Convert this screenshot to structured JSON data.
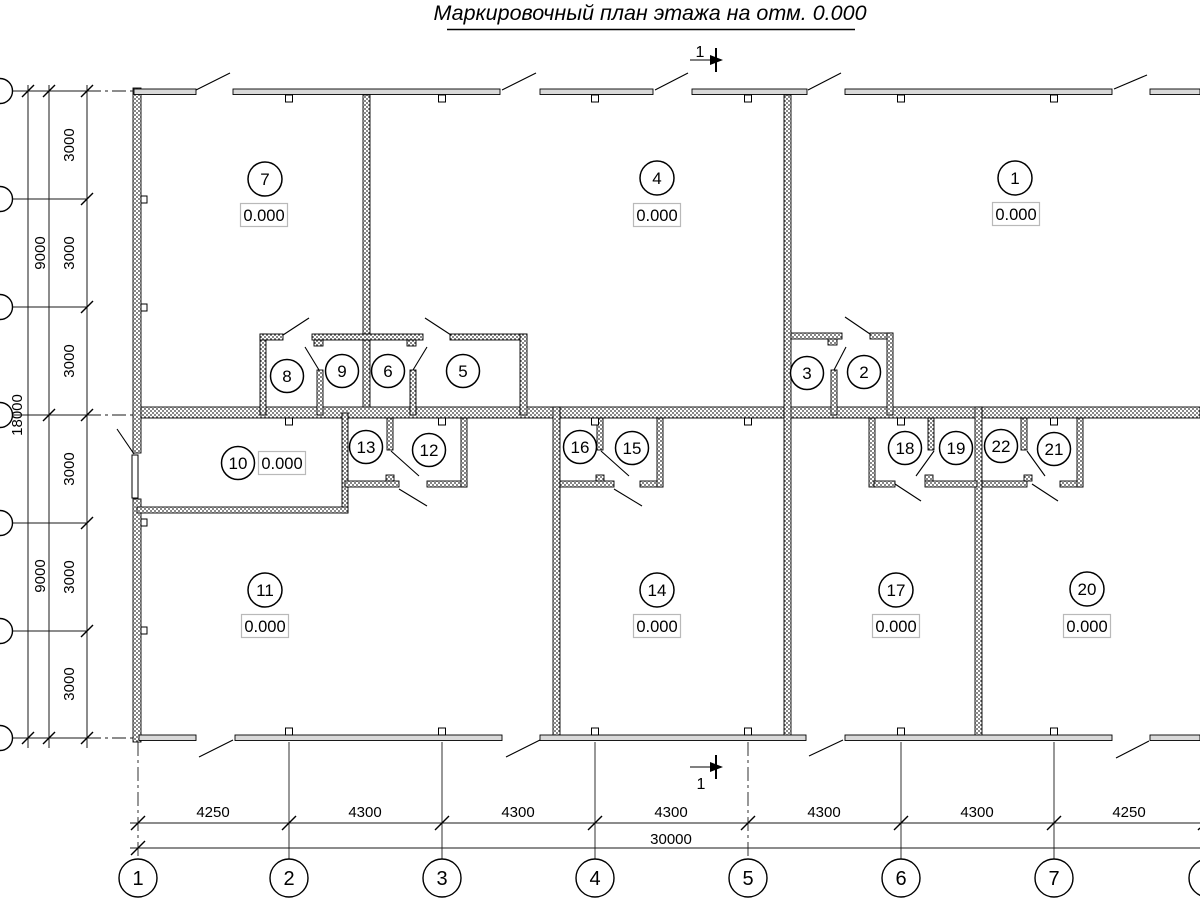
{
  "title": "Маркировочный план этажа на отм. 0.000",
  "elevation_value": "0.000",
  "section": {
    "label": "1"
  },
  "room_numbers": [
    "1",
    "2",
    "3",
    "4",
    "5",
    "6",
    "7",
    "8",
    "9",
    "10",
    "11",
    "12",
    "13",
    "14",
    "15",
    "16",
    "17",
    "18",
    "19",
    "20",
    "21",
    "22"
  ],
  "axes_bottom": [
    "1",
    "2",
    "3",
    "4",
    "5",
    "6",
    "7"
  ],
  "dims": {
    "bottom": [
      "4250",
      "4300",
      "4300",
      "4300",
      "4300",
      "4300",
      "4250"
    ],
    "bottom_total": "30000",
    "left_segments": [
      "3000",
      "3000",
      "3000",
      "3000",
      "3000",
      "3000"
    ],
    "left_mid": [
      "9000",
      "9000"
    ],
    "left_total": "18000"
  }
}
